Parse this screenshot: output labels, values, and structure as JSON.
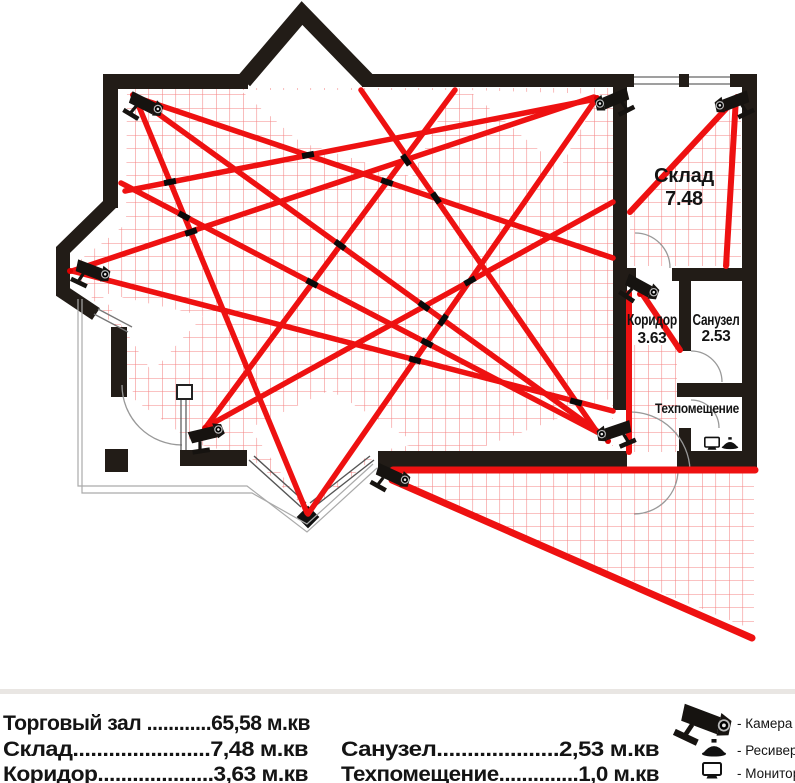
{
  "plan": {
    "title": "CCTV camera placement floor plan",
    "rooms": {
      "sklad": {
        "name": "Склад",
        "area": "7.48"
      },
      "koridor": {
        "name": "Коридор",
        "area": "3.63"
      },
      "sanuzel": {
        "name": "Санузел",
        "area": "2.53"
      },
      "tehpom": {
        "name": "Техпомещение"
      }
    },
    "camera_count": 8
  },
  "footer": {
    "left": [
      "Торговый зал ............65,58  м.кв",
      "Склад.......................7,48  м.кв",
      "Коридор....................3,63  м.кв"
    ],
    "right": [
      "Санузел....................2,53  м.кв",
      "Техпомещение..............1,0  м.кв"
    ]
  },
  "legend": {
    "items": [
      {
        "icon": "camera-icon",
        "label": "- Камера"
      },
      {
        "icon": "receiver-icon",
        "label": "- Ресивер"
      },
      {
        "icon": "monitor-icon",
        "label": "- Монитор"
      }
    ]
  },
  "colors": {
    "wall": "#221c17",
    "beam": "#ee1111",
    "grid": "#f05050",
    "text": "#141414"
  }
}
